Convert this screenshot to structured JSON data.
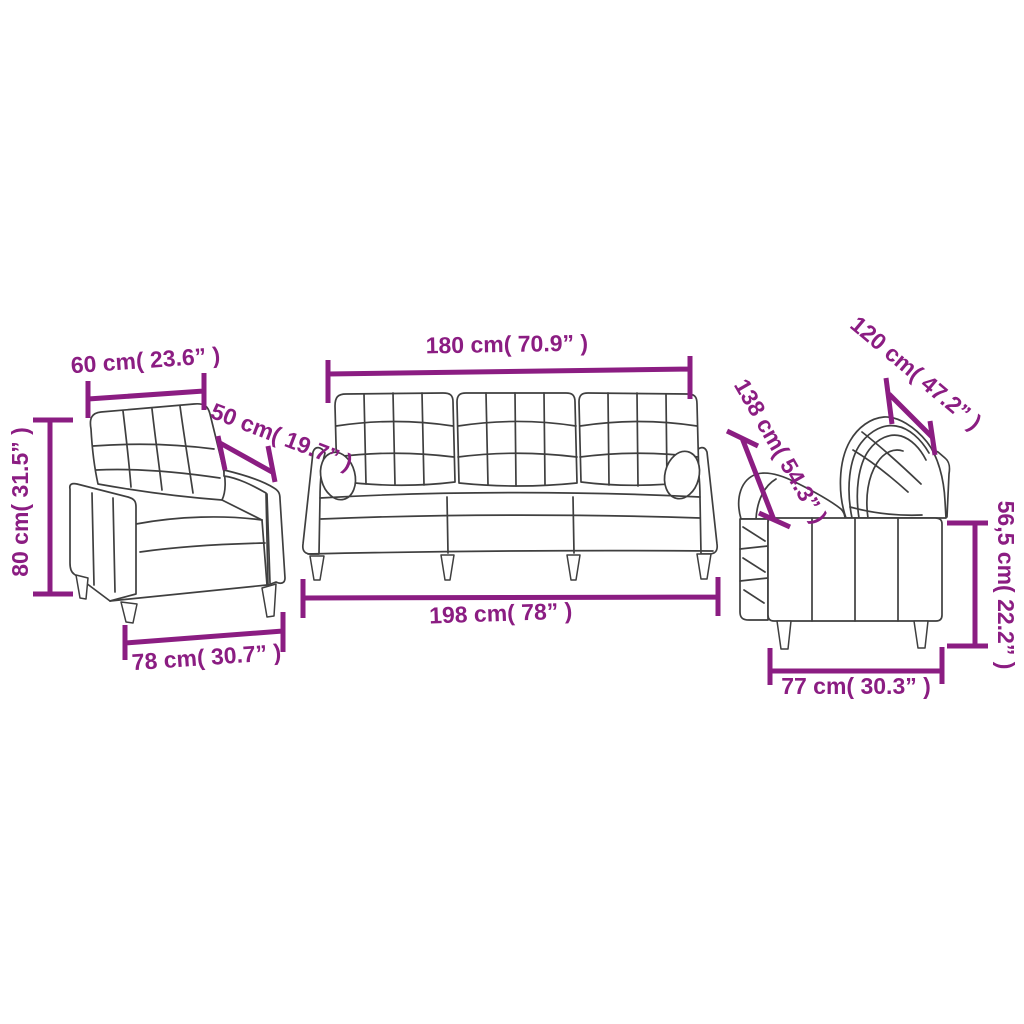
{
  "colors": {
    "dimension": "#8b1d82",
    "line_art": "#3f3f3f"
  },
  "pieces": {
    "armchair": {
      "name": "armchair",
      "width": "60 cm( 23.6” )",
      "depth": "50 cm( 19.7” )",
      "height": "80 cm( 31.5” )",
      "base_width": "78 cm( 30.7” )"
    },
    "sofa_3_seater": {
      "name": "3-seater sofa",
      "width": "180 cm( 70.9” )",
      "base_width": "198 cm( 78” )"
    },
    "sofa_2_seater": {
      "name": "2-seater sofa",
      "width": "120 cm( 47.2” )",
      "depth": "138 cm( 54.3” )",
      "height": "56,5 cm( 22.2” )",
      "base_width": "77 cm( 30.3” )"
    }
  }
}
